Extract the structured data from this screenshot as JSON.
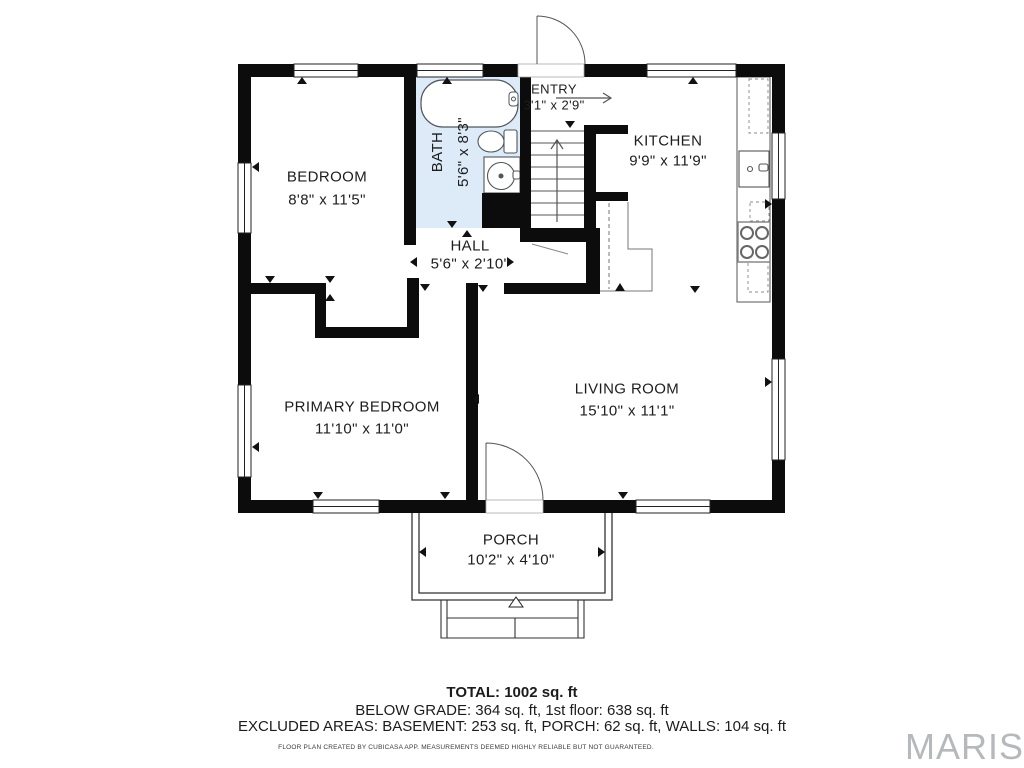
{
  "rooms": {
    "bedroom": {
      "name": "BEDROOM",
      "dims": "8'8\" x 11'5\""
    },
    "bath": {
      "name": "BATH",
      "dims": "5'6\" x 8'3\""
    },
    "entry": {
      "name": "ENTRY",
      "dims": "3'1\" x 2'9\""
    },
    "kitchen": {
      "name": "KITCHEN",
      "dims": "9'9\" x 11'9\""
    },
    "hall": {
      "name": "HALL",
      "dims": "5'6\" x 2'10\""
    },
    "primary_bedroom": {
      "name": "PRIMARY BEDROOM",
      "dims": "11'10\" x 11'0\""
    },
    "living_room": {
      "name": "LIVING ROOM",
      "dims": "15'10\" x 11'1\""
    },
    "porch": {
      "name": "PORCH",
      "dims": "10'2\" x 4'10\""
    }
  },
  "summary": {
    "total": "TOTAL: 1002 sq. ft",
    "below_grade_line": "BELOW GRADE: 364 sq. ft, 1st floor: 638 sq. ft",
    "excluded_line": "EXCLUDED AREAS: BASEMENT: 253 sq. ft, PORCH: 62 sq. ft, WALLS: 104 sq. ft"
  },
  "disclaimer": "FLOOR PLAN CREATED BY CUBICASA APP. MEASUREMENTS DEEMED HIGHLY RELIABLE BUT NOT GUARANTEED.",
  "watermark": "MARIS",
  "colors": {
    "wall": "#0c0c0c",
    "bath_floor": "#dcebf7",
    "fixture_line": "#50565c",
    "text": "#1d1d1f",
    "watermark": "#b6b9bc"
  }
}
